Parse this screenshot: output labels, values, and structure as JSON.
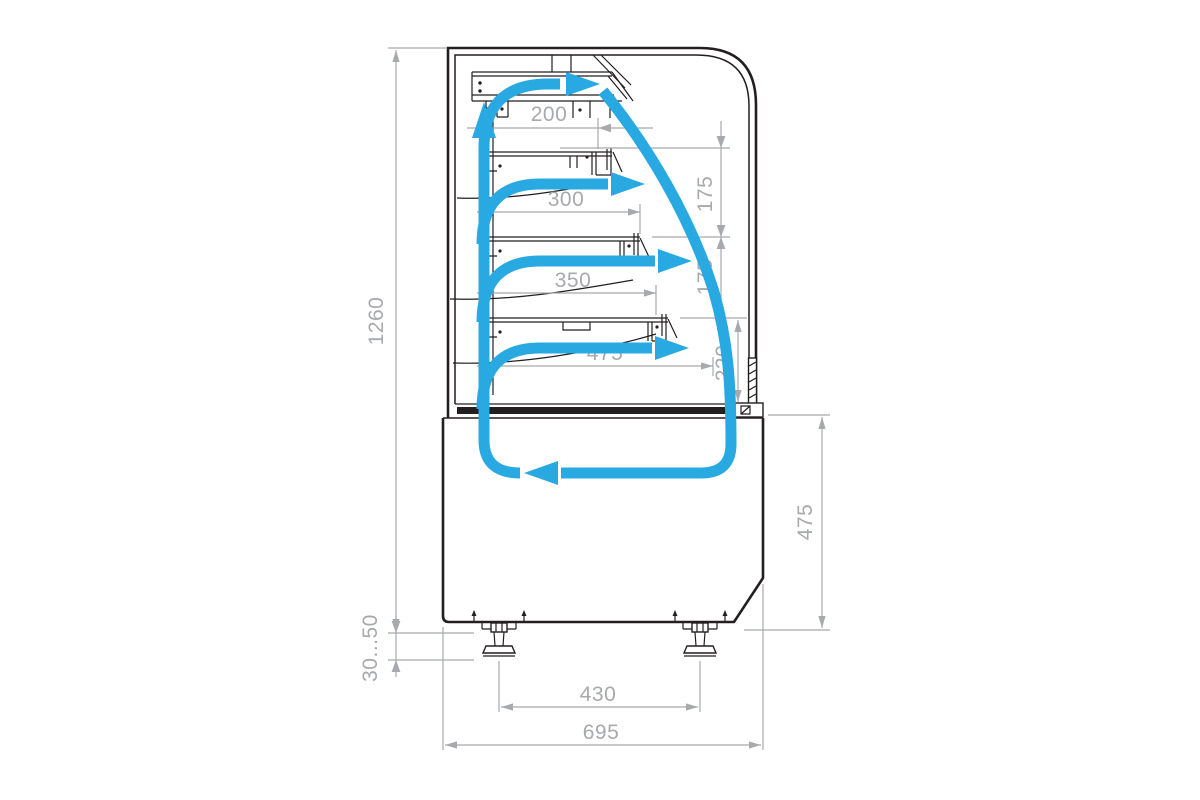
{
  "drawing": {
    "type": "refrigerated-display-case-side-section",
    "units": "mm"
  },
  "colors": {
    "ink": "#231f20",
    "dim": "#a7a9ac",
    "flow": "#29a9e1",
    "paper": "#ffffff"
  },
  "dimensions": {
    "total_height": "1260",
    "leg_adjustment": "30...50",
    "overall_depth": "695",
    "leg_spacing": "430",
    "base_height": "475",
    "shelf1_depth": "200",
    "shelf2_depth": "300",
    "shelf3_depth": "350",
    "deck_depth": "475",
    "gap_shelf1_shelf2": "175",
    "gap_shelf2_shelf3": "175",
    "gap_shelf3_deck": "220"
  }
}
